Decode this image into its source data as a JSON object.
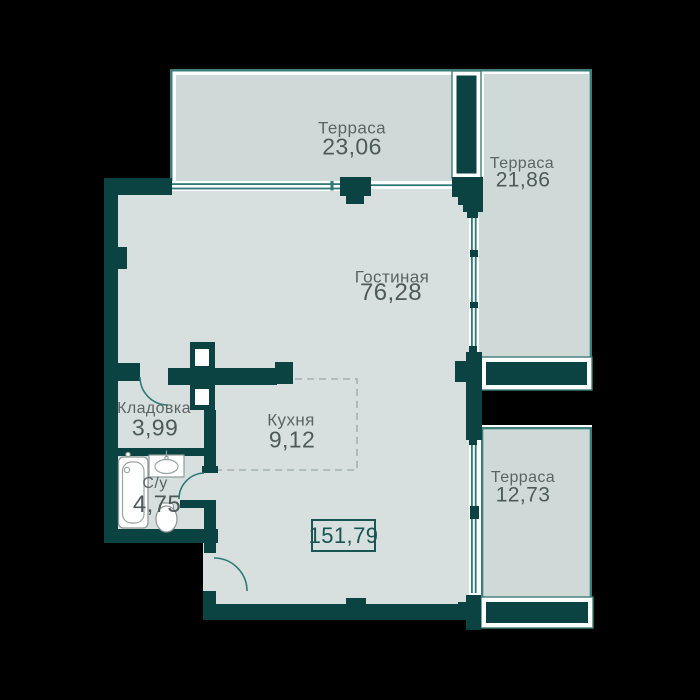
{
  "plan": {
    "type": "apartment-floor-plan",
    "language": "ru",
    "total_area": "151,79",
    "rooms": [
      {
        "id": "terrace-top",
        "label": "Терраса",
        "area": "23,06"
      },
      {
        "id": "terrace-right",
        "label": "Терраса",
        "area": "21,86"
      },
      {
        "id": "living-room",
        "label": "Гостиная",
        "area": "76,28"
      },
      {
        "id": "storage",
        "label": "Кладовка",
        "area": "3,99"
      },
      {
        "id": "kitchen",
        "label": "Кухня",
        "area": "9,12"
      },
      {
        "id": "bathroom",
        "label": "С/у",
        "area": "4,75"
      },
      {
        "id": "terrace-bottom",
        "label": "Терраса",
        "area": "12,73"
      }
    ],
    "fixtures": [
      "bathtub",
      "sink",
      "toilet"
    ],
    "colors": {
      "background": "#000000",
      "wall": "#0b4342",
      "interior_floor": "#d7e0de",
      "terrace_floor": "#cfdad8",
      "window_line": "#2e7a77",
      "terrace_border": "#3f7d7a",
      "label_text": "#5b6462",
      "area_text": "#4e5a58",
      "total_text": "#185553",
      "dashed_zone": "#a3b1b0",
      "fixture_stroke": "#8e9b99"
    }
  }
}
